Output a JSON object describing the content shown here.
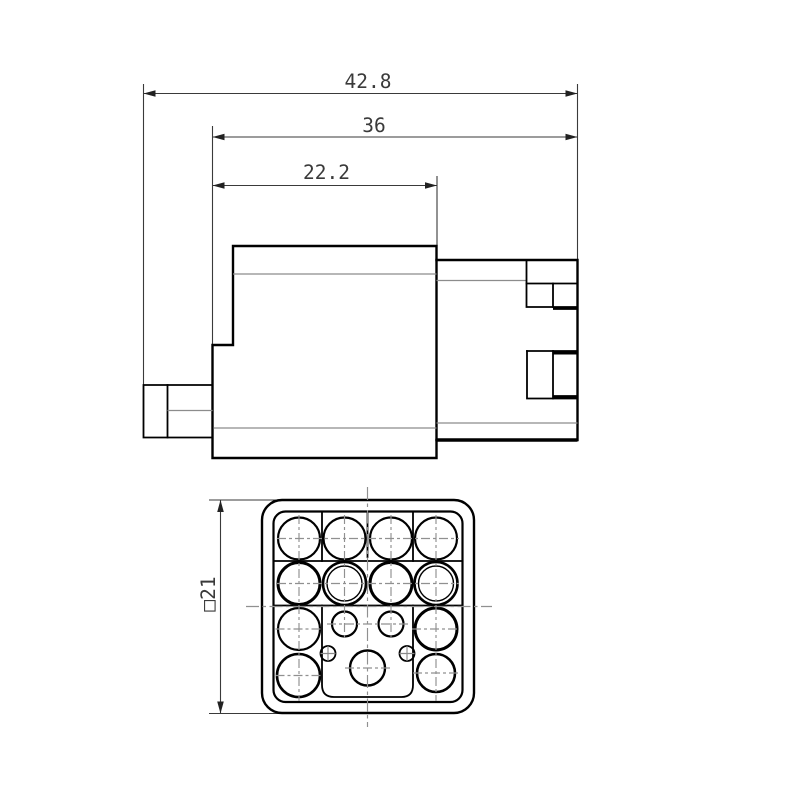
{
  "drawing": {
    "background": "#ffffff",
    "colors": {
      "object_line": "#000000",
      "thin_line": "#8c8c8c",
      "dimension_line": "#3a3a3a",
      "centerline": "#909090"
    },
    "side_view": {
      "dimensions": [
        {
          "id": "overall_length",
          "label": "42.8"
        },
        {
          "id": "housing_length",
          "label": "36"
        },
        {
          "id": "front_section_length",
          "label": "22.2"
        }
      ]
    },
    "face_view": {
      "dimensions": [
        {
          "id": "face_size",
          "label": "□21"
        }
      ]
    }
  }
}
